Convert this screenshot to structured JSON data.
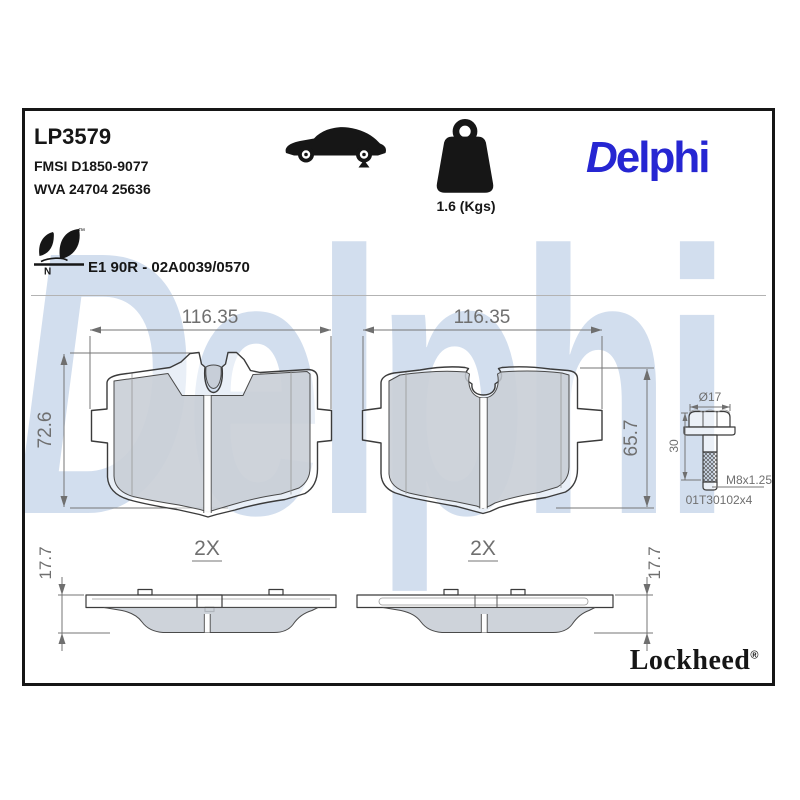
{
  "header": {
    "part_number": "LP3579",
    "fmsi": "FMSI D1850-9077",
    "wva": "WVA 24704 25636",
    "weight_label": "1.6 (Kgs)",
    "brand_logo": "Delphi",
    "eco_tm": "™",
    "eco_letter": "N",
    "approval": "E1 90R - 02A0039/0570"
  },
  "watermark": {
    "text": "Delphi"
  },
  "drawings": {
    "pad_front_left": {
      "width_dim": "116.35",
      "height_dim": "72.6",
      "qty": "2X"
    },
    "pad_front_right": {
      "width_dim": "116.35",
      "height_dim": "65.7",
      "qty": "2X"
    },
    "pad_side_left": {
      "thickness_dim": "17.7"
    },
    "pad_side_right": {
      "thickness_dim": "17.7"
    },
    "bolt": {
      "head_diameter": "Ø17",
      "length": "30",
      "thread": "M8x1.25",
      "part_code": "01T30102x4"
    }
  },
  "footer": {
    "brand": "Lockheed",
    "registered": "®"
  },
  "colors": {
    "brand_blue": "#2626d2",
    "watermark_blue": "#d2deee",
    "friction_gray": "#d2d2d2",
    "line_dark": "#3b3b3b",
    "dimension_gray": "#6f6f6f",
    "border_black": "#161616"
  }
}
